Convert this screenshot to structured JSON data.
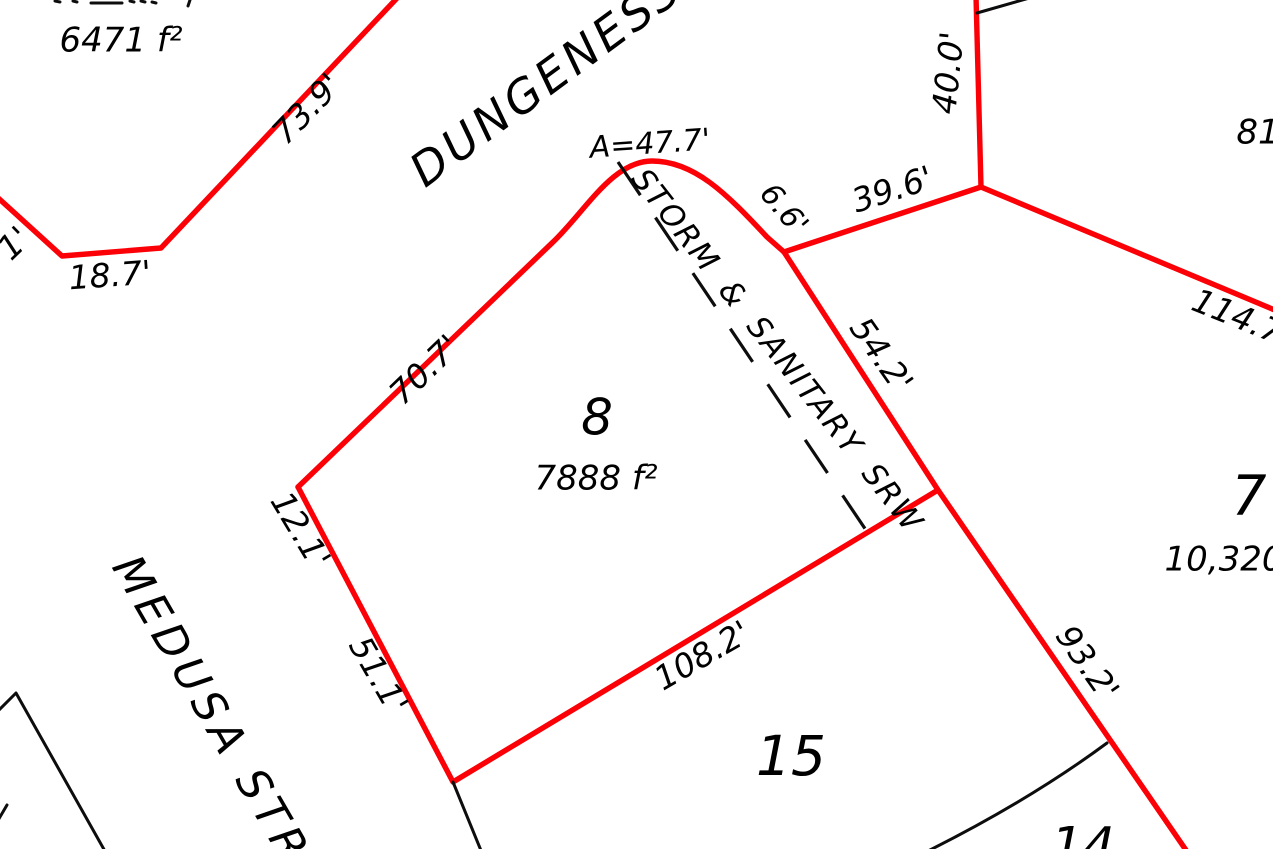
{
  "colors": {
    "boundary_red": "#fb0006",
    "line_black": "#0d0d0d"
  },
  "streets": {
    "dungeness": "DUNGENESS",
    "medusa": "MEDUSA STR"
  },
  "easement": {
    "label": "STORM & SANITARY SRW"
  },
  "lots": {
    "lot8": {
      "number": "8",
      "area": "7888 f²"
    },
    "lot15": {
      "number": "15"
    },
    "lot14": {
      "number": "14"
    },
    "lot7": {
      "number": "7",
      "area": "10,320"
    },
    "lot_northwest": {
      "area": "6471 f²"
    }
  },
  "dimensions": {
    "d73_9": "73.9'",
    "d18_7": "18.7'",
    "edge_fragment": "1'",
    "d70_7": "70.7'",
    "d12_1": "12.1'",
    "d51_1": "51.1'",
    "arc_a": "A=47.7'",
    "d6_6": "6.6'",
    "d39_6": "39.6'",
    "d40_0": "40.0'",
    "d114_7": "114.7",
    "d81": "81",
    "d54_2": "54.2'",
    "d93_2": "93.2'",
    "d108_2": "108.2'"
  }
}
